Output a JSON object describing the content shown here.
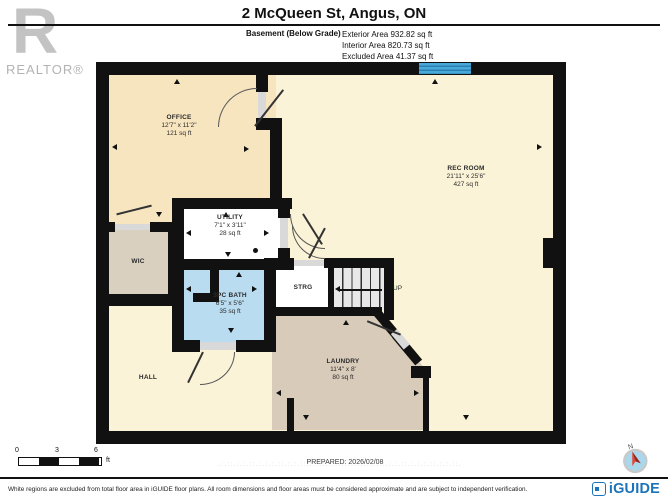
{
  "header": {
    "title": "2 McQueen St, Angus, ON",
    "floor_label": "Basement (Below Grade)",
    "areas": [
      "Exterior Area 932.82 sq ft",
      "Interior Area 820.73 sq ft",
      "Excluded Area 41.37 sq ft"
    ]
  },
  "branding": {
    "realtor_letter": "R",
    "realtor_text": "REALTOR®",
    "iguide_text": "iGUIDE",
    "compass_n": "N"
  },
  "rooms": {
    "office": {
      "name": "OFFICE",
      "dims": "12'7\" x 11'2\"",
      "area": "121 sq ft"
    },
    "rec": {
      "name": "REC ROOM",
      "dims": "21'11\" x 25'6\"",
      "area": "427 sq ft"
    },
    "utility": {
      "name": "UTILITY",
      "dims": "7'1\" x 3'11\"",
      "area": "28 sq ft"
    },
    "wic": {
      "name": "WIC"
    },
    "bath": {
      "name": "3PC BATH",
      "dims": "6'5\" x 5'6\"",
      "area": "35 sq ft"
    },
    "strg": {
      "name": "STRG"
    },
    "stairs": {
      "label": "UP"
    },
    "laundry": {
      "name": "LAUNDRY",
      "dims": "11'4\" x 8'",
      "area": "80 sq ft"
    },
    "hall": {
      "name": "HALL"
    }
  },
  "scale_bar": {
    "labels": [
      "0",
      "3",
      "6"
    ],
    "unit": "ft"
  },
  "prepared": "PREPARED: 2026/02/08",
  "watermark": ".:.::.:.:.::.:.:.:.::.:.:.::.:.:.:.::.:.:.::.:.:.:.::.:.:.::.:.:.:.::.:.:.::.",
  "footer": {
    "disclaimer": "White regions are excluded from total floor area in iGUIDE floor plans. All room dimensions and floor areas must be considered approximate and are subject to independent verification."
  },
  "colors": {
    "wall": "#111111",
    "office_fill": "#f7e5c0",
    "rec_hall_fill": "#fbf3d7",
    "wic_laundry_fill": "#d8cbba",
    "bath_fill": "#badcf0",
    "window_blue": "#47a8da",
    "iguide_blue": "#1b74bb",
    "realtor_grey": "#c3c3c3",
    "compass_needle_red": "#d9352b"
  }
}
